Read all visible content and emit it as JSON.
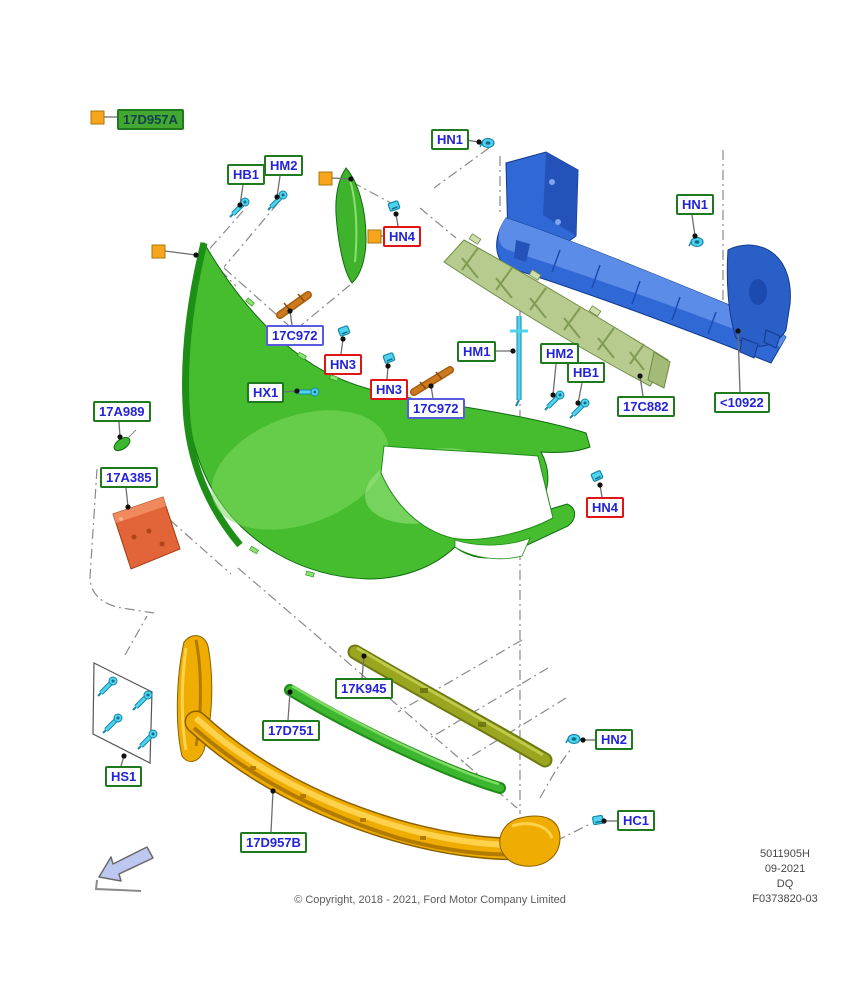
{
  "diagram": {
    "copyright": "© Copyright, 2018 - 2021, Ford Motor Company Limited",
    "doc_info": [
      "5011905H",
      "09-2021",
      "DQ",
      "F0373820-03"
    ],
    "colors": {
      "label_text": "#2323d7",
      "green_border": "#1f7a1f",
      "blue_border": "#5a5ae0",
      "red_border": "#e01414",
      "filled_label_bg": "#43a832",
      "orange_marker": "#f6a51c",
      "fastener_cyan": "#4fd4ef",
      "bumper_green": "#46bd2e",
      "beam_blue": "#3069d6",
      "absorber_sage": "#b7cb8e",
      "valance_gold": "#eead00",
      "bracket_orange": "#cd7a1e",
      "plate_salmon": "#e2653a",
      "strip_olive": "#9aa61f",
      "strip_green": "#3cb72f",
      "arrow_fill": "#bcc8f0"
    },
    "parts": [
      {
        "ref": "17D957A",
        "part": "front-bumper-cover"
      },
      {
        "ref": "17D957B",
        "part": "lower-valance-panel"
      },
      {
        "ref": "<10922",
        "part": "bumper-reinforcement-beam"
      },
      {
        "ref": "17C882",
        "part": "energy-absorber"
      },
      {
        "ref": "17C972",
        "part": "side-bracket"
      },
      {
        "ref": "17A385",
        "part": "license-plate-bracket"
      },
      {
        "ref": "17A989",
        "part": "plug"
      },
      {
        "ref": "17K945",
        "part": "upper-grille-strip"
      },
      {
        "ref": "17D751",
        "part": "lower-grille-strip"
      },
      {
        "ref": "HS1",
        "part": "screw-kit"
      }
    ],
    "callouts": [
      {
        "ref": "17D957A",
        "style": "filled",
        "x": 117,
        "y": 109,
        "line": null,
        "square": [
          91,
          111
        ]
      },
      {
        "ref": "HB1",
        "style": "green",
        "x": 227,
        "y": 164,
        "line": [
          243,
          185,
          240,
          205
        ]
      },
      {
        "ref": "HM2",
        "style": "green",
        "x": 264,
        "y": 155,
        "line": [
          280,
          176,
          277,
          197
        ]
      },
      {
        "ref": "HN1",
        "style": "green",
        "x": 431,
        "y": 129,
        "line": [
          466,
          140,
          479,
          142
        ]
      },
      {
        "ref": "HN4",
        "style": "red",
        "x": 383,
        "y": 226,
        "line": [
          398,
          226,
          396,
          214
        ],
        "square": [
          368,
          230
        ]
      },
      {
        "ref": "HN1",
        "style": "green",
        "x": 676,
        "y": 194,
        "line": [
          692,
          215,
          695,
          236
        ]
      },
      {
        "ref": "17C972",
        "style": "blue",
        "x": 266,
        "y": 325,
        "line": [
          292,
          325,
          290,
          311
        ]
      },
      {
        "ref": "HN3",
        "style": "red",
        "x": 324,
        "y": 354,
        "line": [
          341,
          354,
          343,
          339
        ]
      },
      {
        "ref": "HX1",
        "style": "green",
        "x": 247,
        "y": 382,
        "line": [
          282,
          392,
          297,
          391
        ]
      },
      {
        "ref": "HN3",
        "style": "red",
        "x": 370,
        "y": 379,
        "line": [
          387,
          379,
          388,
          366
        ]
      },
      {
        "ref": "17C972",
        "style": "blue",
        "x": 407,
        "y": 398,
        "line": [
          433,
          398,
          431,
          386
        ]
      },
      {
        "ref": "HM1",
        "style": "green",
        "x": 457,
        "y": 341,
        "line": [
          492,
          351,
          513,
          351
        ]
      },
      {
        "ref": "HM2",
        "style": "green",
        "x": 540,
        "y": 343,
        "line": [
          556,
          364,
          553,
          395
        ]
      },
      {
        "ref": "HB1",
        "style": "green",
        "x": 567,
        "y": 362,
        "line": [
          582,
          383,
          578,
          403
        ]
      },
      {
        "ref": "17C882",
        "style": "green",
        "x": 617,
        "y": 396,
        "line": [
          643,
          396,
          640,
          376
        ]
      },
      {
        "ref": "<10922",
        "style": "green",
        "x": 714,
        "y": 392,
        "line": [
          740,
          392,
          738,
          331
        ]
      },
      {
        "ref": "17A989",
        "style": "green",
        "x": 93,
        "y": 401,
        "line": [
          119,
          422,
          120,
          437
        ]
      },
      {
        "ref": "17A385",
        "style": "green",
        "x": 100,
        "y": 467,
        "line": [
          126,
          488,
          128,
          507
        ]
      },
      {
        "ref": "HN4",
        "style": "red",
        "x": 586,
        "y": 497,
        "line": [
          602,
          497,
          600,
          485
        ]
      },
      {
        "ref": "17K945",
        "style": "green",
        "x": 335,
        "y": 678,
        "line": [
          362,
          678,
          364,
          656
        ]
      },
      {
        "ref": "17D751",
        "style": "green",
        "x": 262,
        "y": 720,
        "line": [
          288,
          720,
          290,
          692
        ]
      },
      {
        "ref": "HS1",
        "style": "green",
        "x": 105,
        "y": 766,
        "line": [
          121,
          766,
          124,
          756
        ]
      },
      {
        "ref": "17D957B",
        "style": "green",
        "x": 240,
        "y": 832,
        "line": [
          271,
          832,
          273,
          791
        ]
      },
      {
        "ref": "HN2",
        "style": "green",
        "x": 595,
        "y": 729,
        "line": [
          595,
          740,
          583,
          740
        ]
      },
      {
        "ref": "HC1",
        "style": "green",
        "x": 617,
        "y": 810,
        "line": [
          617,
          821,
          604,
          821
        ]
      }
    ],
    "markers": [
      {
        "x": 152,
        "y": 245,
        "line": [
          165,
          251,
          196,
          255
        ]
      },
      {
        "x": 319,
        "y": 172,
        "line": [
          332,
          178,
          351,
          179
        ]
      }
    ]
  }
}
